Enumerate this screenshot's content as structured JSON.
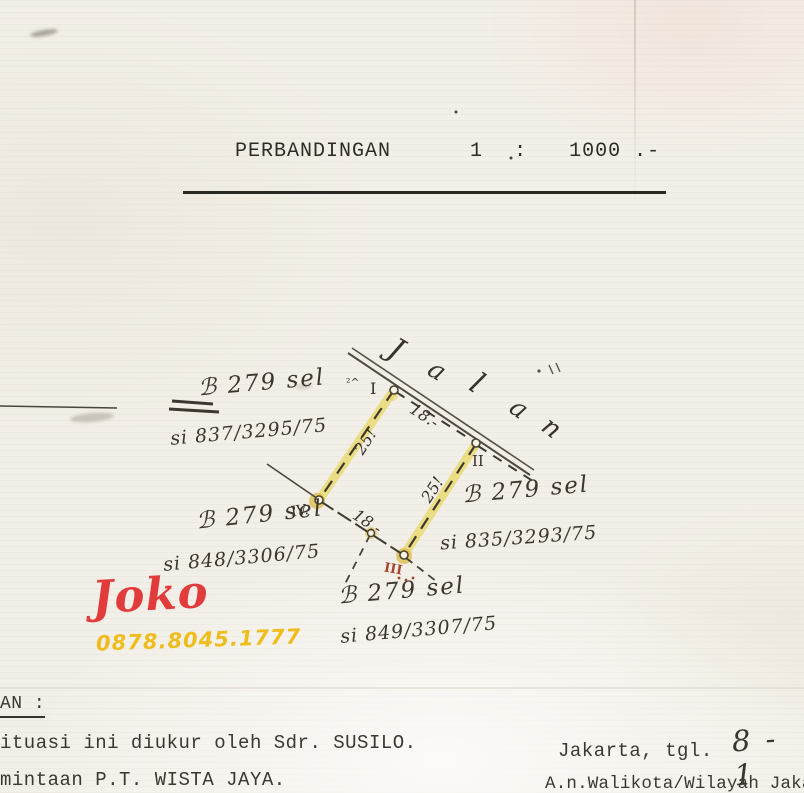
{
  "title": {
    "scale_label": "PERBANDINGAN",
    "ratio_left": "1",
    "colon": ":",
    "ratio_right": "1000 .-"
  },
  "diagram": {
    "road_letters": [
      "J",
      "a",
      "l",
      "a",
      "n"
    ],
    "measurements": {
      "top": "18.-",
      "left": "25!",
      "right": "25!",
      "bottom": "18.-"
    },
    "corner_marks": {
      "i": "I",
      "ii": "II",
      "iii": "III",
      "iv": "IV.",
      "flourish": "²^"
    },
    "plots": [
      {
        "name": "ℬ 279 sel",
        "ref": "si 837/3295/75"
      },
      {
        "name": "ℬ 279 sel",
        "ref": "si 848/3306/75"
      },
      {
        "name": "ℬ 279 sel",
        "ref": "si 835/3293/75"
      },
      {
        "name": "ℬ 279 sel",
        "ref": "si 849/3307/75"
      }
    ],
    "colors": {
      "ink": "#3f3a30",
      "highlight": "#ead96c",
      "corner_gold": "#ddba45",
      "red_mark": "#a8442b"
    }
  },
  "watermark": {
    "name": "Joko",
    "phone": "0878.8045.1777",
    "name_color": "#e23b3b",
    "phone_color": "#eebd1d"
  },
  "footer": {
    "left": {
      "heading": "AN :",
      "line1": "ituasi ini diukur oleh Sdr. SUSILO.",
      "line2": "mintaan P.T. WISTA JAYA."
    },
    "right": {
      "city_line": "Jakarta, tgl.",
      "date_handwritten": "8 - 1",
      "authority": "A.n.Walikota/Wilayah Jakart"
    }
  }
}
